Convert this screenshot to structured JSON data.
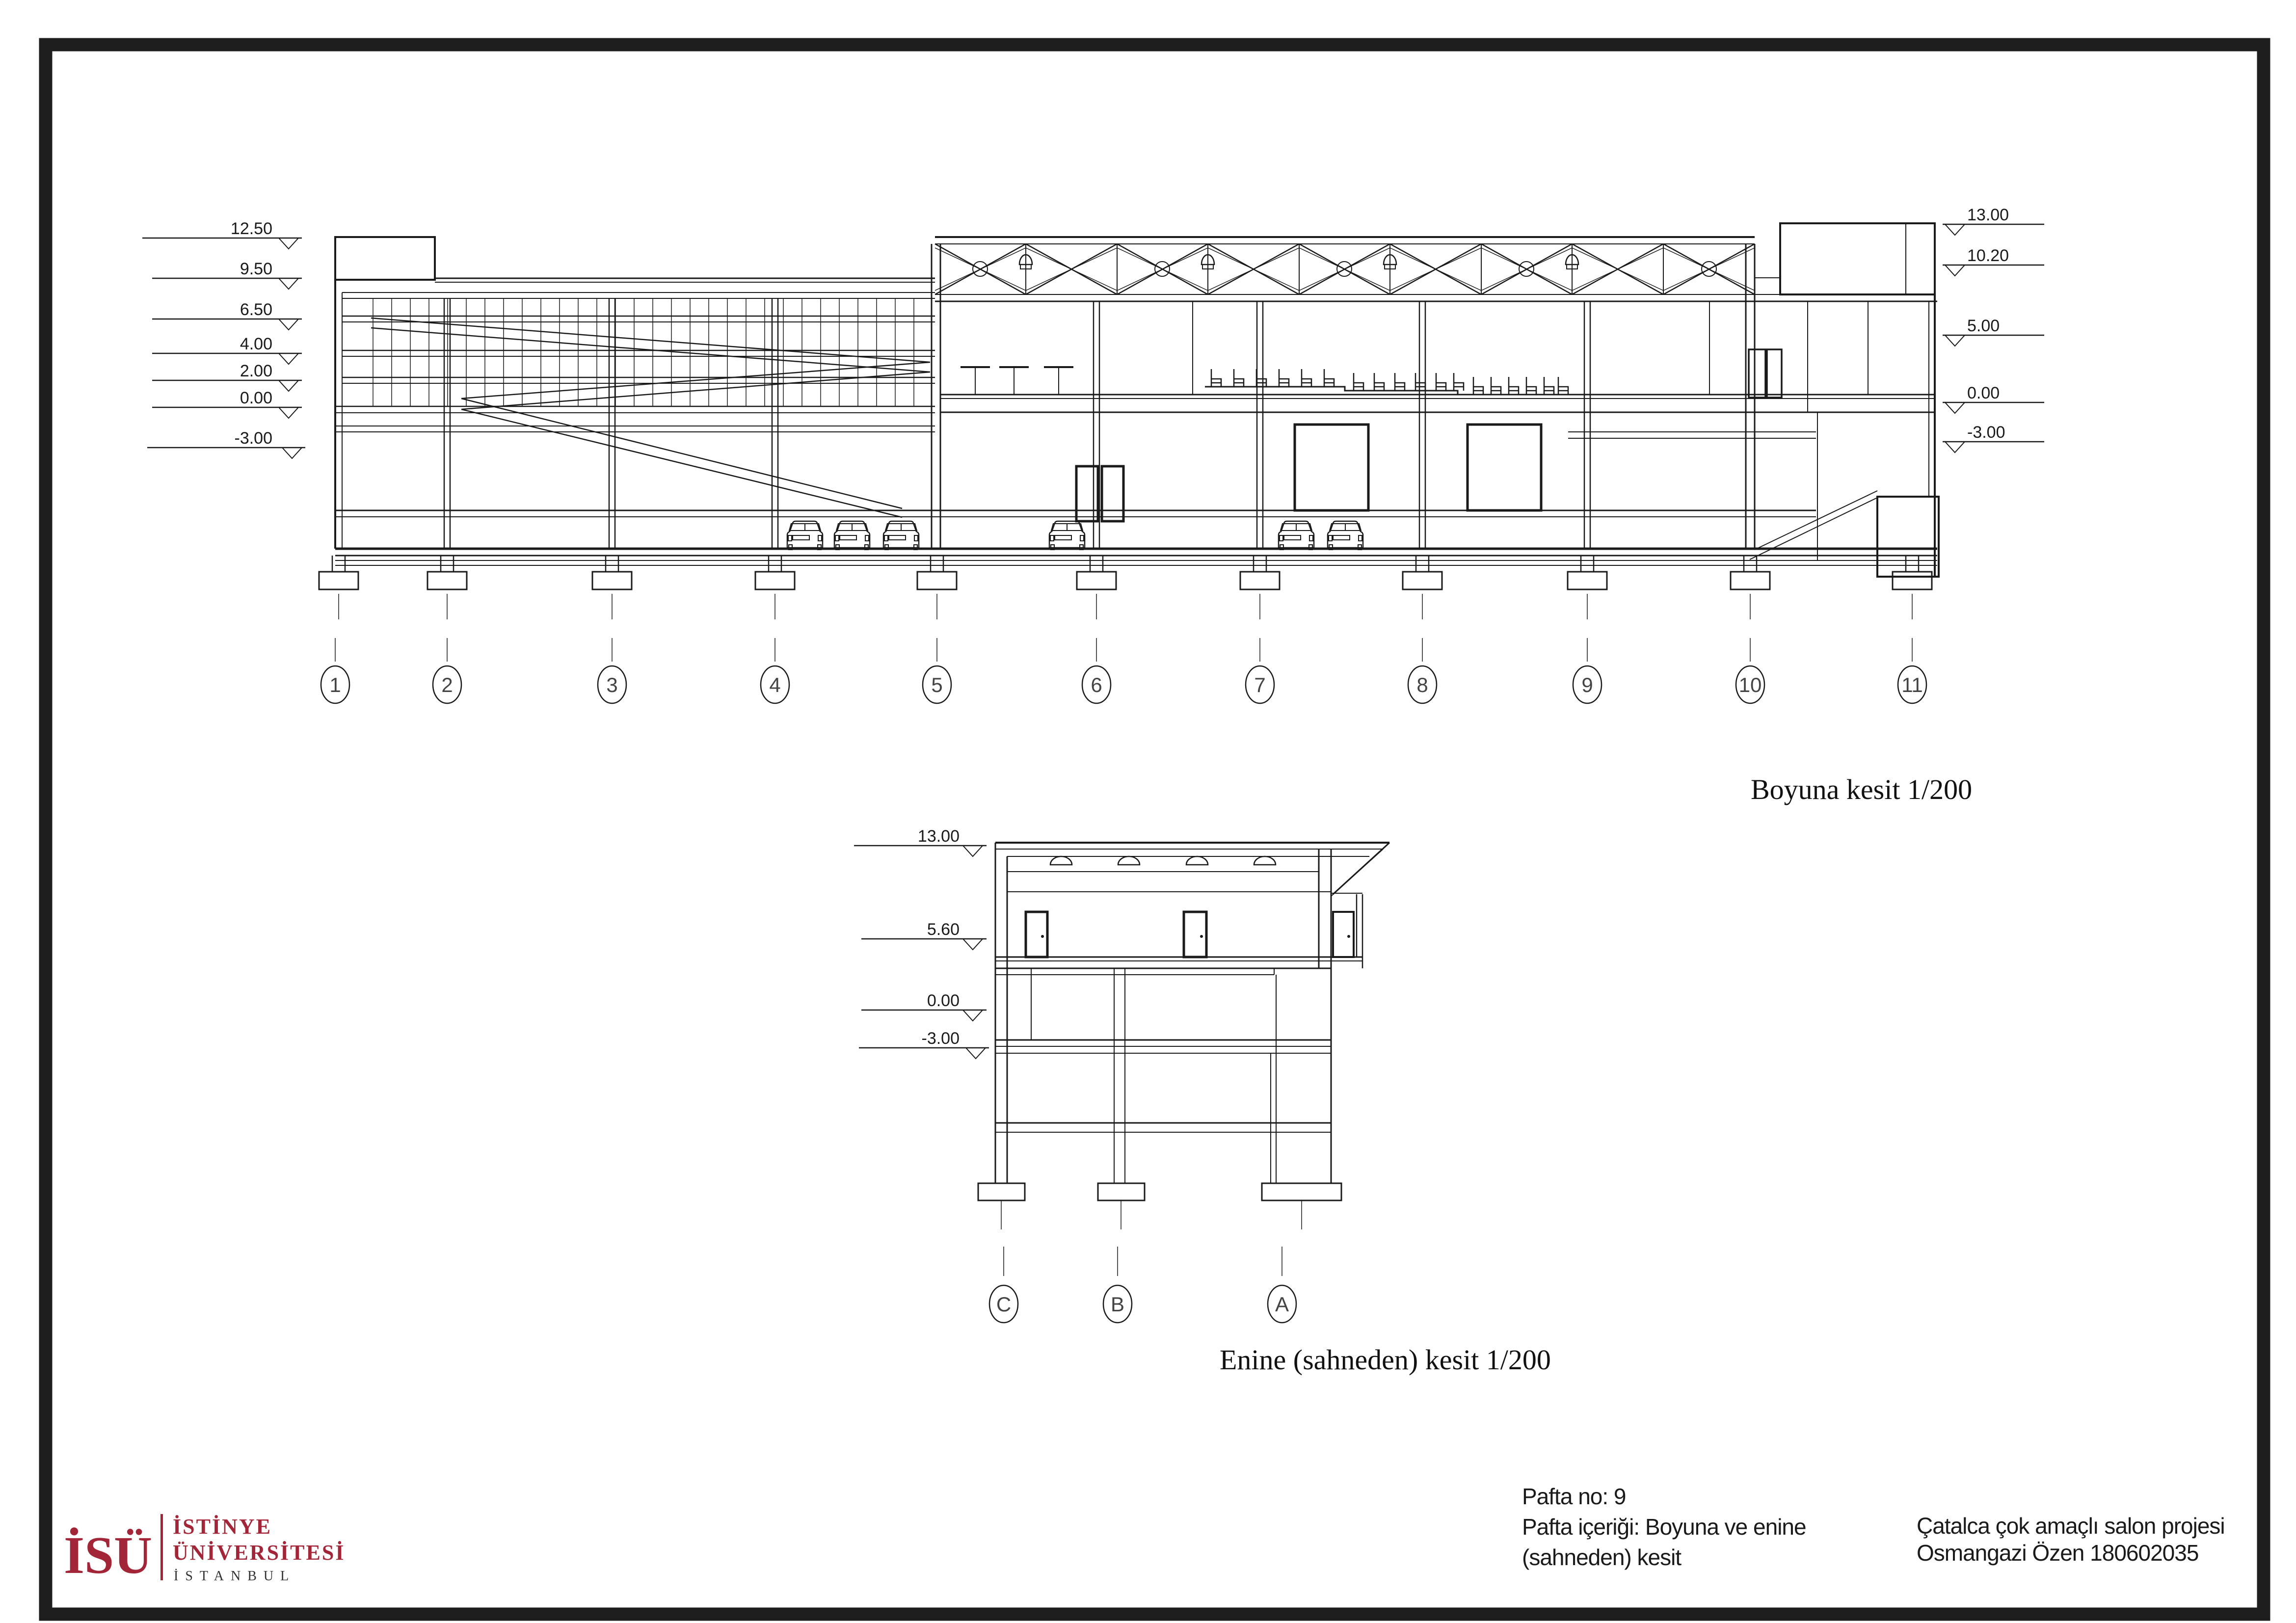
{
  "sheet": {
    "long_section": {
      "caption": "Boyuna kesit  1/200",
      "left_levels": [
        "12.50",
        "9.50",
        "6.50",
        "4.00",
        "2.00",
        "0.00",
        "-3.00"
      ],
      "right_levels": [
        "13.00",
        "10.20",
        "5.00",
        "0.00",
        "-3.00"
      ],
      "grid_labels": [
        "1",
        "2",
        "3",
        "4",
        "5",
        "6",
        "7",
        "8",
        "9",
        "10",
        "11"
      ]
    },
    "cross_section": {
      "caption": "Enine (sahneden) kesit  1/200",
      "left_levels": [
        "13.00",
        "5.60",
        "0.00",
        "-3.00"
      ],
      "grid_labels": [
        "C",
        "B",
        "A"
      ]
    },
    "title_block": {
      "logo_text": "İSÜ",
      "university_line1": "İSTİNYE",
      "university_line2": "ÜNİVERSİTESİ",
      "university_line3": "İSTANBUL",
      "sheet_no": "Pafta no: 9",
      "content_line1": "Pafta içeriği: Boyuna ve enine",
      "content_line2": "(sahneden) kesit",
      "project_line1": "Çatalca çok amaçlı salon projesi",
      "project_line2": "Osmangazi Özen 180602035",
      "brand_red": "#A32638"
    }
  }
}
